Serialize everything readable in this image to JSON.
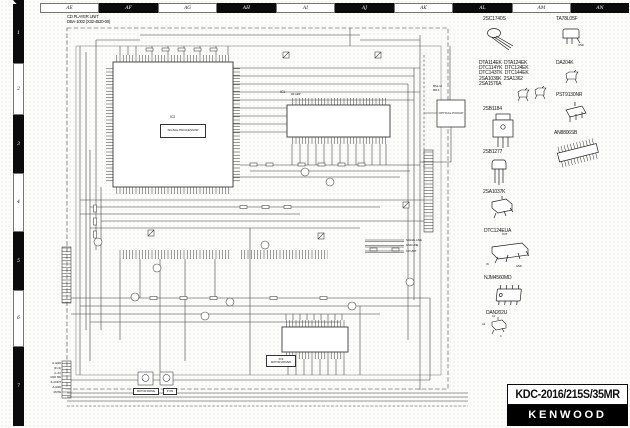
{
  "sheet": {
    "grid_columns": [
      "AE",
      "AF",
      "AG",
      "AH",
      "AI",
      "AJ",
      "AK",
      "AL",
      "AM",
      "AN"
    ],
    "grid_rows": [
      "1",
      "2",
      "3",
      "4",
      "5",
      "6",
      "7"
    ]
  },
  "unit": {
    "title": "CD PLAYER UNIT",
    "subtitle": "DBA-1002 (X32-4520-00)"
  },
  "ics": {
    "ic1": {
      "ref": "IC1",
      "desc": "RF AMP"
    },
    "ic2": {
      "ref": "IC2",
      "desc": "SIGNAL PROCESSOR"
    },
    "ic3": {
      "ref": "IC3",
      "desc": "MOTOR DRIVER"
    }
  },
  "optical_pickup": {
    "label": "OPTICAL PICKUP",
    "model_line1": "MSL-1J",
    "model_line2": "MR-F"
  },
  "legend": {
    "line1": "SIGNAL LINE",
    "line2": "GND LINE",
    "line3": "CD UNIT"
  },
  "connectors": {
    "cn1_pins": [
      "IL-GND",
      "(R ch)",
      "(L ch)",
      "GND SW",
      "IL-CONT",
      "A-GND",
      "MUTE"
    ]
  },
  "callouts": {
    "motor_drive": "MOTOR DRIVE",
    "p_on": "P ON"
  },
  "packages": [
    {
      "name": "2SC1740S"
    },
    {
      "name": "TA78L05F"
    },
    {
      "name": "DTA114EK  DTA124EK"
    },
    {
      "name": "DTC114YK  DTC124EK"
    },
    {
      "name": "DTC143TK  DTC144EK"
    },
    {
      "name": "2SA1036K  2SA1362"
    },
    {
      "name": "2SA1576A"
    },
    {
      "name": "DA204K"
    },
    {
      "name": "PST9130NR"
    },
    {
      "name": "2SB1184"
    },
    {
      "name": "AN8806SB"
    },
    {
      "name": "2SB1277"
    },
    {
      "name": "2SA1037K"
    },
    {
      "name": "DTC124EUA"
    },
    {
      "name": "NJM4560MD"
    },
    {
      "name": "DAN202U"
    }
  ],
  "package_pin_labels": {
    "ta78l05f_gnd": "GND",
    "dtc124eua_out": "OUT",
    "dtc124eua_in": "IN",
    "dtc124eua_gnd": "GND",
    "dan202u_a1": "A1",
    "dan202u_a2": "A2",
    "dan202u_c": "C"
  },
  "title_block": {
    "model": "KDC-2016/215S/35MR",
    "brand": "KENWOOD"
  }
}
